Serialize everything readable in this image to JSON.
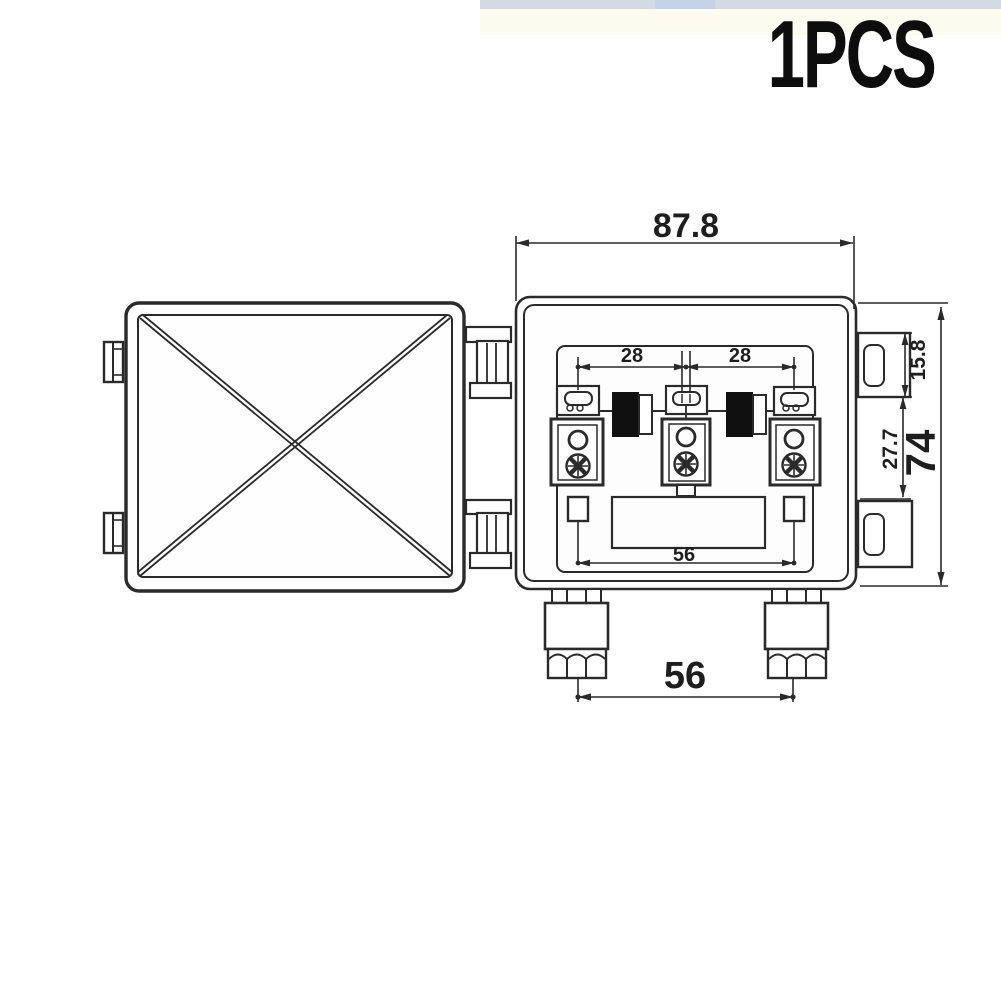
{
  "header": {
    "qty_label": "1PCS",
    "top_bar_color": "#d3dae3"
  },
  "drawing": {
    "line_color": "#2a2a2a",
    "dims": {
      "overall_width": "87.8",
      "overall_height": "74",
      "flange_height": "15.8",
      "flange_gap": "27.7",
      "pitch_left": "28",
      "pitch_right": "28",
      "terminal_span": "56",
      "gland_span": "56"
    }
  }
}
